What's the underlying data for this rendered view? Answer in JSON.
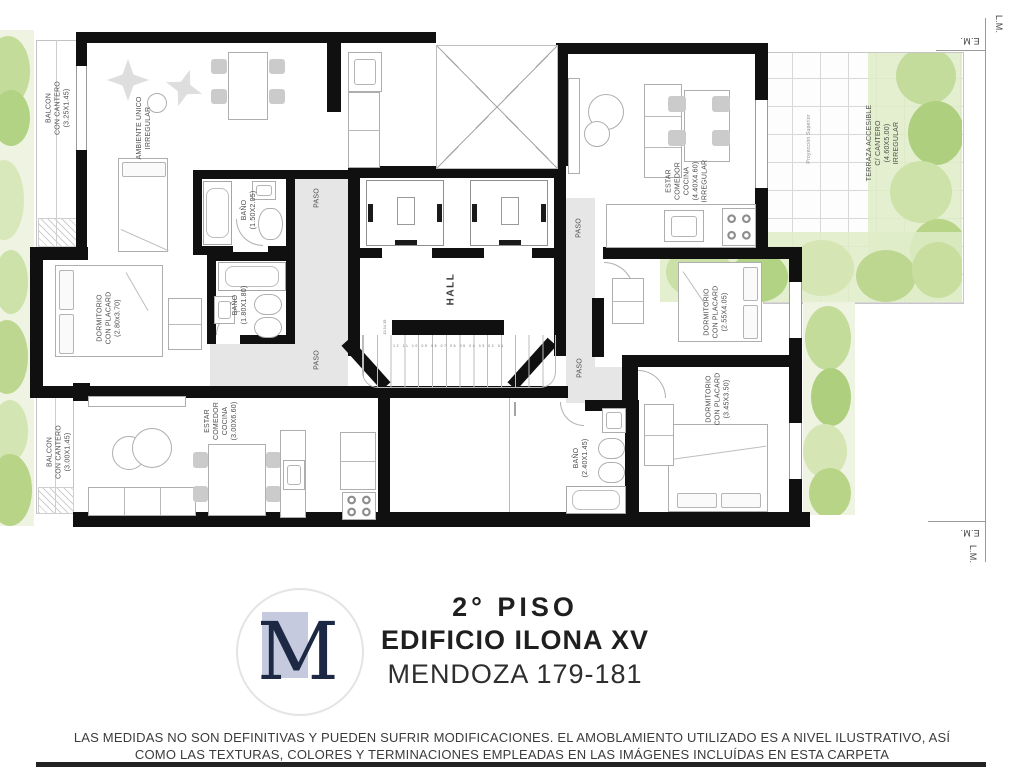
{
  "plan": {
    "labels": {
      "balcon_nw": "BALCON\nCON CANTERO\n(3.25X1.45)",
      "ambiente_unico": "AMBIENTE UNICO\nIRREGULAR",
      "bano_nw": "BAÑO\n(1.50X2.05)",
      "bano_w": "BAÑO\n(1.80X1.80)",
      "dormitorio_w": "DORMITORIO\nCON PLACARD\n(2.80x3.70)",
      "balcon_sw": "BALCON\nCON CANTERO\n(3.00X1.45)",
      "estar_sw": "ESTAR\nCOMEDOR\nCOCINA\n(3.00X6.60)",
      "hall": "HALL",
      "paso": "PASO",
      "estar_ne": "ESTAR\nCOMEDOR\nCOCINA\n(4.40X4.60)\nIRREGULAR",
      "terraza": "TERRAZA ACCESIBLE\nC/ CANTERO\n(4.60X5.00)\nIRREGULAR",
      "proyeccion_superior": "Proyección Superior",
      "dormitorio_e": "DORMITORIO\nCON PLACARD\n(2.55X4.05)",
      "dormitorio_se": "DORMITORIO\nCON PLACARD\n(3.45X3.50)",
      "bano_se": "BAÑO\n(2.40X1.45)"
    },
    "stairs": {
      "run_numbers": "12 11 10 09 08 07 06 05 04 03 02 01",
      "landing_numbers": "13 14 15"
    },
    "boundary": {
      "lm": "L.M.",
      "em": "E.M."
    }
  },
  "title_block": {
    "logo_letter": "M",
    "floor": "2° PISO",
    "building": "EDIFICIO ILONA XV",
    "address": "MENDOZA 179-181"
  },
  "disclaimer": {
    "line1": "LAS MEDIDAS NO SON DEFINITIVAS Y PUEDEN SUFRIR MODIFICACIONES. EL AMOBLAMIENTO UTILIZADO ES A NIVEL ILUSTRATIVO, ASÍ",
    "line2": "COMO LAS TEXTURAS, COLORES Y TERMINACIONES EMPLEADAS EN LAS IMÁGENES INCLUÍDAS EN ESTA CARPETA"
  }
}
